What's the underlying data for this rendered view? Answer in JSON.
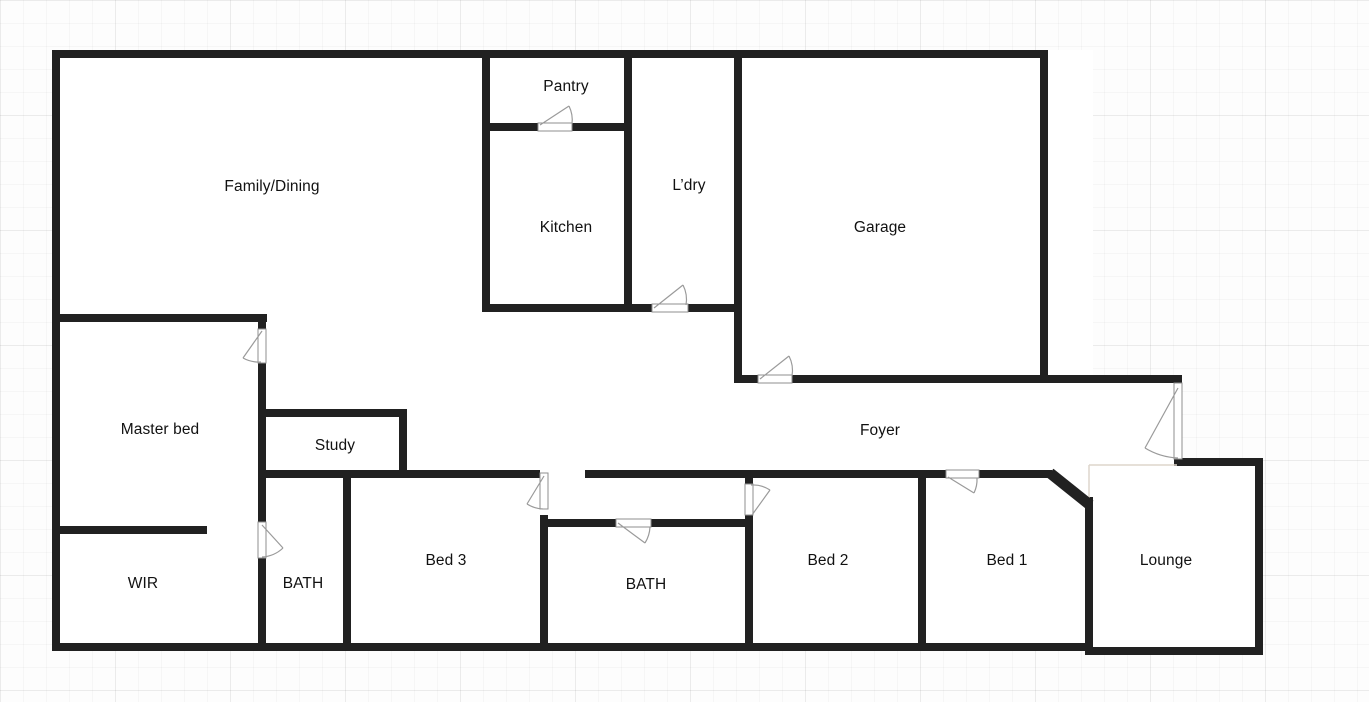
{
  "colors": {
    "wall": "#212121",
    "door_line": "#9a9a9a",
    "leaf_fill": "#ffffff",
    "leaf_border": "#8f8f8f",
    "faint_line": "#ddd6cc",
    "label": "#111111",
    "floor": "#ffffff",
    "background": "#fdfdfd"
  },
  "floorplan": {
    "rooms": [
      {
        "id": "family-dining",
        "label": "Family/Dining",
        "cx": 272,
        "cy": 187
      },
      {
        "id": "pantry",
        "label": "Pantry",
        "cx": 566,
        "cy": 87
      },
      {
        "id": "kitchen",
        "label": "Kitchen",
        "cx": 566,
        "cy": 228
      },
      {
        "id": "laundry",
        "label": "L’dry",
        "cx": 689,
        "cy": 186
      },
      {
        "id": "garage",
        "label": "Garage",
        "cx": 880,
        "cy": 228
      },
      {
        "id": "master-bed",
        "label": "Master bed",
        "cx": 160,
        "cy": 430
      },
      {
        "id": "study",
        "label": "Study",
        "cx": 335,
        "cy": 446
      },
      {
        "id": "foyer",
        "label": "Foyer",
        "cx": 880,
        "cy": 431
      },
      {
        "id": "wir",
        "label": "WIR",
        "cx": 143,
        "cy": 584
      },
      {
        "id": "bath-1",
        "label": "BATH",
        "cx": 303,
        "cy": 584
      },
      {
        "id": "bed-3",
        "label": "Bed 3",
        "cx": 446,
        "cy": 561
      },
      {
        "id": "bath-2",
        "label": "BATH",
        "cx": 646,
        "cy": 585
      },
      {
        "id": "bed-2",
        "label": "Bed 2",
        "cx": 828,
        "cy": 561
      },
      {
        "id": "bed-1",
        "label": "Bed 1",
        "cx": 1007,
        "cy": 561
      },
      {
        "id": "lounge",
        "label": "Lounge",
        "cx": 1166,
        "cy": 561
      }
    ],
    "floor_areas": [
      [
        52,
        50,
        1041,
        601
      ],
      [
        1048,
        375,
        134,
        90
      ],
      [
        1085,
        458,
        178,
        197
      ]
    ],
    "walls": [
      {
        "id": "outer-top",
        "r": [
          52,
          50,
          996,
          8
        ]
      },
      {
        "id": "outer-left",
        "r": [
          52,
          50,
          8,
          601
        ]
      },
      {
        "id": "outer-bottom",
        "r": [
          52,
          643,
          1041,
          8
        ]
      },
      {
        "id": "lounge-bottom",
        "r": [
          1085,
          647,
          178,
          8
        ]
      },
      {
        "id": "outer-right",
        "r": [
          1255,
          458,
          8,
          197
        ]
      },
      {
        "id": "lounge-top",
        "r": [
          1174,
          458,
          89,
          8
        ]
      },
      {
        "id": "lounge-left",
        "r": [
          1085,
          497,
          8,
          158
        ]
      },
      {
        "id": "hall-top-left",
        "r": [
          262,
          470,
          278,
          8
        ]
      },
      {
        "id": "hall-top-mid",
        "r": [
          585,
          470,
          361,
          8
        ]
      },
      {
        "id": "hall-top-right",
        "r": [
          979,
          470,
          73,
          8
        ]
      },
      {
        "id": "bed3-left",
        "r": [
          343,
          470,
          8,
          181
        ]
      },
      {
        "id": "bed3-right-lower",
        "r": [
          540,
          515,
          8,
          136
        ]
      },
      {
        "id": "bath2-top-left",
        "r": [
          548,
          519,
          68,
          8
        ]
      },
      {
        "id": "bath2-top-right",
        "r": [
          651,
          519,
          94,
          8
        ]
      },
      {
        "id": "bed2-divider-stub",
        "r": [
          745,
          470,
          8,
          14
        ]
      },
      {
        "id": "bed2-divider-lower",
        "r": [
          745,
          515,
          8,
          136
        ]
      },
      {
        "id": "bed2-bed1-divider",
        "r": [
          918,
          470,
          8,
          181
        ]
      },
      {
        "id": "master-top",
        "r": [
          52,
          314,
          215,
          8
        ]
      },
      {
        "id": "master-right-a",
        "r": [
          258,
          314,
          8,
          15
        ]
      },
      {
        "id": "master-right-b",
        "r": [
          258,
          363,
          8,
          159
        ]
      },
      {
        "id": "master-right-c",
        "r": [
          258,
          558,
          8,
          93
        ]
      },
      {
        "id": "study-top",
        "r": [
          262,
          409,
          145,
          8
        ]
      },
      {
        "id": "study-right",
        "r": [
          399,
          409,
          8,
          69
        ]
      },
      {
        "id": "wir-wall",
        "r": [
          52,
          526,
          155,
          8
        ]
      },
      {
        "id": "kitchen-left",
        "r": [
          482,
          50,
          8,
          262
        ]
      },
      {
        "id": "kitchen-right",
        "r": [
          624,
          50,
          8,
          262
        ]
      },
      {
        "id": "pantry-bottom-left",
        "r": [
          482,
          123,
          56,
          8
        ]
      },
      {
        "id": "pantry-bottom-right",
        "r": [
          572,
          123,
          60,
          8
        ]
      },
      {
        "id": "kitchen-bottom",
        "r": [
          482,
          304,
          170,
          8
        ]
      },
      {
        "id": "laundry-bottom-right",
        "r": [
          688,
          304,
          54,
          8
        ]
      },
      {
        "id": "garage-left",
        "r": [
          734,
          50,
          8,
          333
        ]
      },
      {
        "id": "garage-bottom-a",
        "r": [
          734,
          375,
          24,
          8
        ]
      },
      {
        "id": "garage-bottom-b",
        "r": [
          792,
          375,
          390,
          8
        ]
      },
      {
        "id": "garage-right",
        "r": [
          1040,
          50,
          8,
          333
        ]
      }
    ],
    "angled_walls": [
      {
        "id": "bed1-lounge-angled-wall",
        "line": [
          1050,
          473,
          1090,
          505
        ],
        "width": 11
      }
    ],
    "doors": [
      {
        "id": "pantry-door",
        "leaf": [
          538,
          123,
          34,
          8
        ],
        "diag": "M540,125 L569,106",
        "arc": "M569,106 A32,32 0 0 1 572,124"
      },
      {
        "id": "laundry-door",
        "leaf": [
          652,
          304,
          36,
          8
        ],
        "diag": "M654,308 L683,285",
        "arc": "M683,285 A32,32 0 0 1 686,305"
      },
      {
        "id": "garage-door",
        "leaf": [
          758,
          375,
          34,
          8
        ],
        "diag": "M760,379 L789,356",
        "arc": "M789,356 A32,32 0 0 1 792,376"
      },
      {
        "id": "master-bed-door",
        "leaf": [
          258,
          329,
          8,
          34
        ],
        "diag": "M262,331 L243,358",
        "arc": "M243,358 A33,33 0 0 0 261,362"
      },
      {
        "id": "bath1-door",
        "leaf": [
          258,
          522,
          8,
          36
        ],
        "diag": "M262,525 L283,548",
        "arc": "M283,548 A33,33 0 0 1 262,557"
      },
      {
        "id": "bed3-door",
        "leaf": [
          540,
          473,
          8,
          36
        ],
        "diag": "M544,476 L527,504",
        "arc": "M543,509 A33,33 0 0 1 527,504"
      },
      {
        "id": "bath2-door",
        "leaf": [
          616,
          519,
          35,
          8
        ],
        "diag": "M618,523 L645,543",
        "arc": "M645,543 A33,33 0 0 0 650,527"
      },
      {
        "id": "bed2-door",
        "leaf": [
          745,
          484,
          8,
          31
        ],
        "diag": "M752,515 L770,490",
        "arc": "M751,485 A31,31 0 0 1 770,490"
      },
      {
        "id": "bed1-door",
        "leaf": [
          946,
          470,
          33,
          8
        ],
        "diag": "M948,477 L974,493",
        "arc": "M974,493 A31,31 0 0 0 977,478"
      },
      {
        "id": "entry-door",
        "leaf": [
          1174,
          383,
          8,
          76
        ],
        "diag": "M1178,388 L1145,448",
        "arc": "M1145,448 A69,69 0 0 0 1178,458"
      }
    ],
    "open_boundary_lines": [
      "M1089,465 L1177,465",
      "M1089,465 L1089,499"
    ]
  }
}
